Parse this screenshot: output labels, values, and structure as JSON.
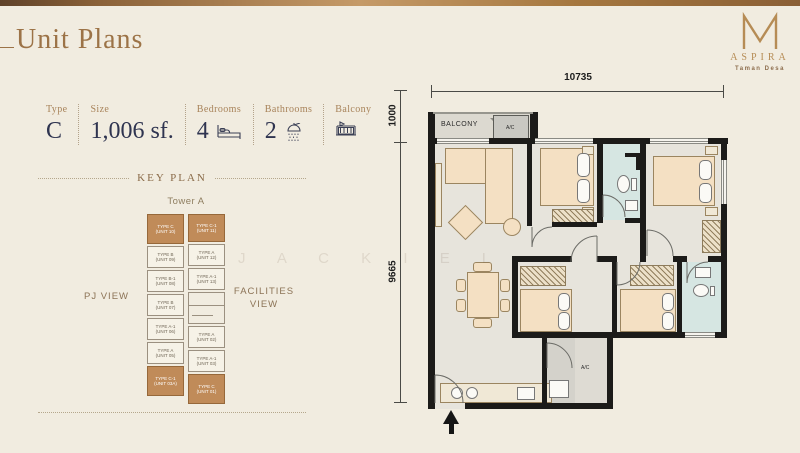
{
  "page": {
    "title": "Unit Plans",
    "watermark": "J A C K I E L",
    "background_color": "#f1ece0",
    "accent_color": "#9c7347"
  },
  "logo": {
    "monogram": "M",
    "brand": "ASPIRA",
    "tagline": "Taman Desa",
    "gold_color": "#b68c55"
  },
  "unit_info": {
    "type_label": "Type",
    "type_value": "C",
    "size_label": "Size",
    "size_value": "1,006 sf.",
    "bedrooms_label": "Bedrooms",
    "bedrooms_value": "4",
    "bathrooms_label": "Bathrooms",
    "bathrooms_value": "2",
    "balcony_label": "Balcony"
  },
  "key_plan": {
    "heading": "KEY PLAN",
    "tower_label": "Tower A",
    "left_view_label": "PJ VIEW",
    "right_view_label": "FACILITIES VIEW",
    "highlight_color": "#c08b59",
    "left_column": [
      {
        "type": "TYPE C",
        "unit": "(UNIT 10)",
        "highlighted": true
      },
      {
        "type": "TYPE B",
        "unit": "(UNIT 09)",
        "highlighted": false
      },
      {
        "type": "TYPE B-1",
        "unit": "(UNIT 08)",
        "highlighted": false
      },
      {
        "type": "TYPE B",
        "unit": "(UNIT 07)",
        "highlighted": false
      },
      {
        "type": "TYPE A-1",
        "unit": "(UNIT 06)",
        "highlighted": false
      },
      {
        "type": "TYPE A",
        "unit": "(UNIT 05)",
        "highlighted": false
      },
      {
        "type": "TYPE C-1",
        "unit": "(UNIT 03A)",
        "highlighted": true
      }
    ],
    "right_column": [
      {
        "type": "TYPE C-1",
        "unit": "(UNIT 11)",
        "highlighted": true
      },
      {
        "type": "TYPE A",
        "unit": "(UNIT 12)",
        "highlighted": false
      },
      {
        "type": "TYPE A-1",
        "unit": "(UNIT 13)",
        "highlighted": false
      },
      {
        "type": "TYPE A",
        "unit": "(UNIT 02)",
        "highlighted": false
      },
      {
        "type": "TYPE A-1",
        "unit": "(UNIT 03)",
        "highlighted": false
      },
      {
        "type": "TYPE C",
        "unit": "(UNIT 01)",
        "highlighted": true
      }
    ]
  },
  "floor_plan": {
    "dimensions": {
      "top_width": "10735",
      "balcony_depth": "1000",
      "unit_depth": "9665"
    },
    "labels": {
      "balcony": "BALCONY",
      "ac_upper": "A/C",
      "ac_yard": "A/C"
    },
    "wall_color": "#1c1b19",
    "floor_color": "#e7e4dc",
    "furniture_color": "#f4e0c3",
    "bathroom_color": "#d6e6e2"
  }
}
